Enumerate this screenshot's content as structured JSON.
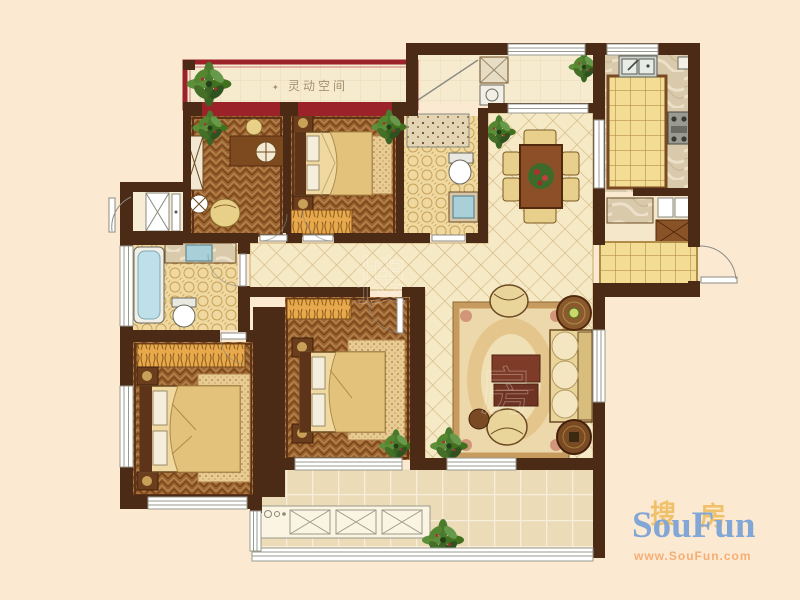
{
  "floorplan": {
    "flexible_space_bullet": "✦",
    "flexible_space_label": " 灵动空间",
    "center_watermark_1": "搜",
    "center_watermark_2": "房"
  },
  "logo": {
    "cn_left": "搜",
    "cn_right": "房",
    "en": "SouFun",
    "url": "www.SouFun.com"
  },
  "colors": {
    "background": "#fce9d2",
    "wall": "#4b2a16",
    "accent_red": "#9b2228",
    "logo_blue": "#7ca3d6",
    "logo_orange": "#efbf66",
    "logo_url": "#f5ab70",
    "label_tan": "#a39070"
  }
}
